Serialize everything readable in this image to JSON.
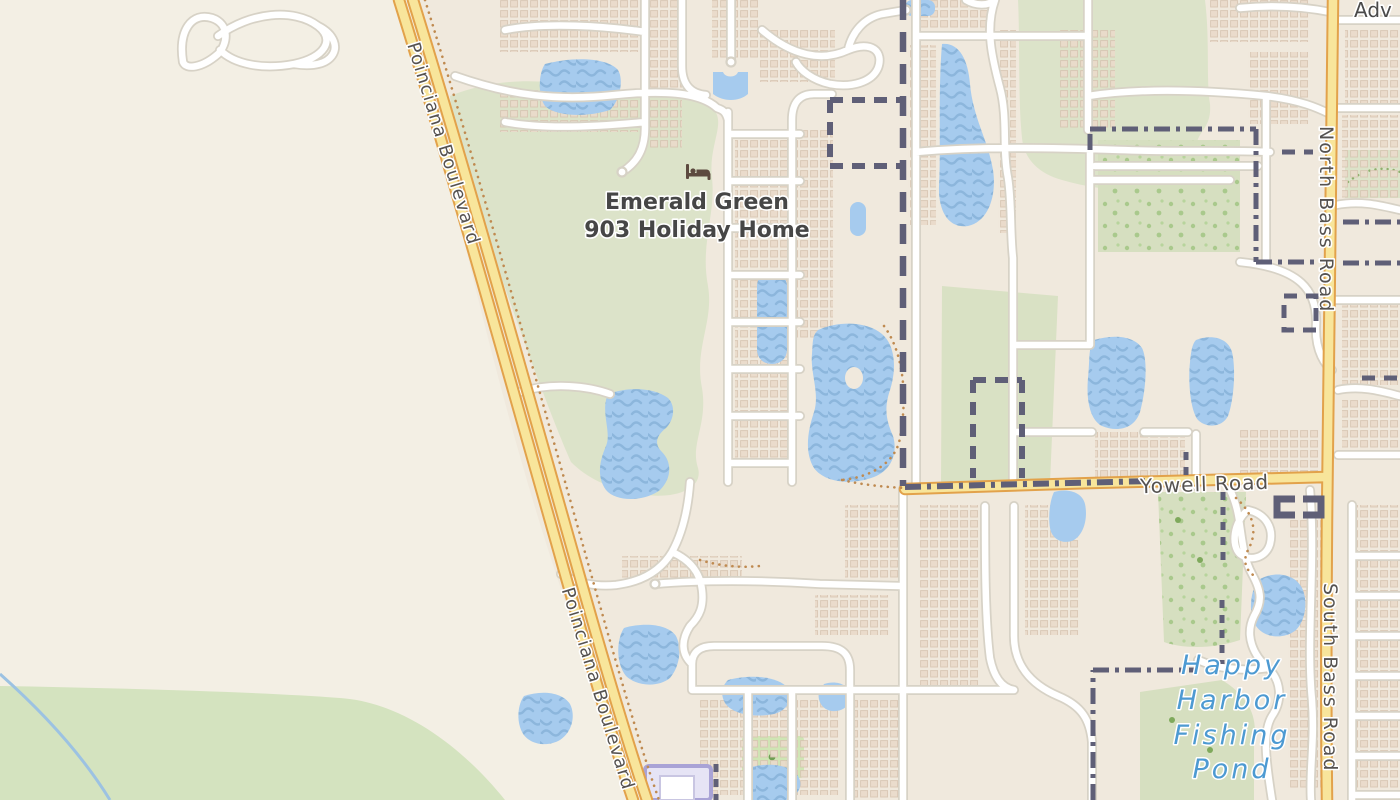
{
  "map": {
    "labels": {
      "poi_name_line1": "Emerald Green",
      "poi_name_line2": "903 Holiday Home",
      "road_poinciana_upper": "Poinciana Boulevard",
      "road_poinciana_lower": "Poinciana Boulevard",
      "road_yowell": "Yowell Road",
      "road_north_bass": "North Bass Road",
      "road_south_bass": "South Bass Road",
      "water_label_lines": [
        "Happy",
        "Harbor",
        "Fishing",
        "Pond"
      ],
      "clipped_top_right": "Adv"
    },
    "icons": {
      "poi_icon": "bed-icon"
    },
    "colors": {
      "background": "#f3efe4",
      "residential": "#f0e9dd",
      "buildings": "#eadbcb",
      "green_area": "#dce3c9",
      "green_bright": "#d4e3bf",
      "water": "#a6cbee",
      "water_wave": "#8cb6dc",
      "road_primary_fill": "#f8e59b",
      "road_primary_casing": "#e2a24b",
      "road_minor_fill": "#ffffff",
      "road_minor_casing": "#d7d2c6",
      "admin_boundary": "#5f5f77",
      "path_dots": "#bf8a50",
      "label_text": "#4a4a4a",
      "water_label_text": "#4d9ad2",
      "poi_icon_color": "#5d4a3f"
    }
  }
}
